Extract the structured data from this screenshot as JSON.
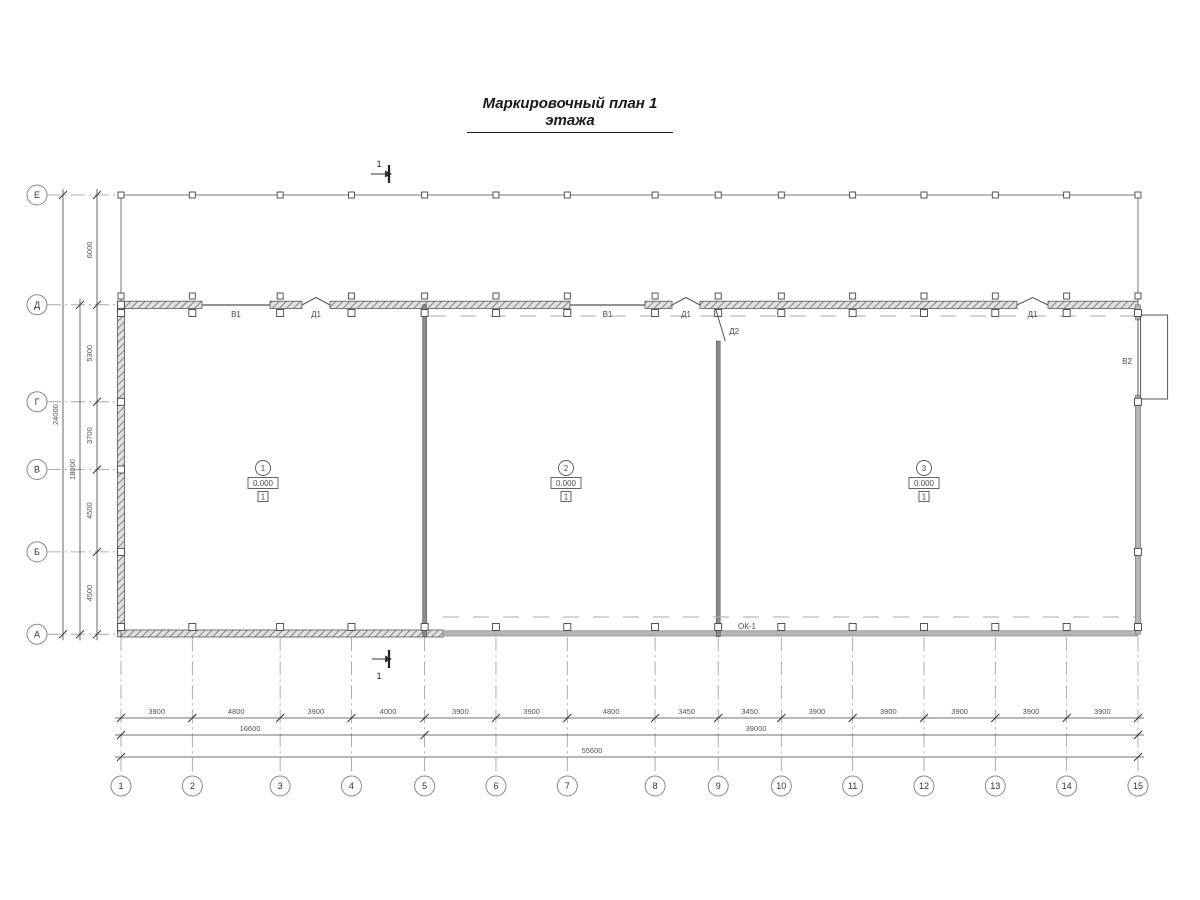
{
  "title": "Маркировочный план 1 этажа",
  "plan": {
    "section_label": "1",
    "axis_rows": [
      {
        "label": "Е"
      },
      {
        "label": "Д"
      },
      {
        "label": "Г"
      },
      {
        "label": "В"
      },
      {
        "label": "Б"
      },
      {
        "label": "А"
      }
    ],
    "row_spans": [
      {
        "label": "6000"
      },
      {
        "label": "5300"
      },
      {
        "label": "3700"
      },
      {
        "label": "4500"
      },
      {
        "label": "4500"
      }
    ],
    "row_totals": [
      {
        "label": "24000",
        "from": 0,
        "to": 5
      },
      {
        "label": "18000",
        "from": 1,
        "to": 5
      }
    ],
    "axis_cols": [
      {
        "label": "1"
      },
      {
        "label": "2"
      },
      {
        "label": "3"
      },
      {
        "label": "4"
      },
      {
        "label": "5"
      },
      {
        "label": "6"
      },
      {
        "label": "7"
      },
      {
        "label": "8"
      },
      {
        "label": "9"
      },
      {
        "label": "10"
      },
      {
        "label": "11"
      },
      {
        "label": "12"
      },
      {
        "label": "13"
      },
      {
        "label": "14"
      },
      {
        "label": "15"
      }
    ],
    "col_spans": [
      {
        "label": "3900"
      },
      {
        "label": "4800"
      },
      {
        "label": "3900"
      },
      {
        "label": "4000"
      },
      {
        "label": "3900"
      },
      {
        "label": "3900"
      },
      {
        "label": "4800"
      },
      {
        "label": "3450"
      },
      {
        "label": "3450"
      },
      {
        "label": "3900"
      },
      {
        "label": "3900"
      },
      {
        "label": "3900"
      },
      {
        "label": "3900"
      },
      {
        "label": "3900"
      }
    ],
    "col_totals": [
      {
        "label": "16600",
        "from": 0,
        "to": 4,
        "lx": 250
      },
      {
        "label": "39000",
        "from": 4,
        "to": 14,
        "lx": 756
      },
      {
        "label": "55600",
        "from": 0,
        "to": 14,
        "lx": 592
      }
    ],
    "openings": {
      "windows_top": [
        {
          "label": "В1",
          "from": 202,
          "to": 270
        },
        {
          "label": "В1",
          "from": 570,
          "to": 645
        }
      ],
      "doors_top": [
        {
          "label": "Д1",
          "from": 302,
          "to": 330
        },
        {
          "label": "Д1",
          "from": 672,
          "to": 700
        },
        {
          "label": "Д1",
          "from": 1017,
          "to": 1048
        }
      ],
      "door_interior": {
        "label": "Д2"
      },
      "gate_right": {
        "label": "В2"
      },
      "window_bottom": {
        "label": "ОК-1"
      }
    },
    "rooms": [
      {
        "number": "1",
        "elevation": "0.000",
        "floor_type": "1",
        "x": 263
      },
      {
        "number": "2",
        "elevation": "0.000",
        "floor_type": "1",
        "x": 566
      },
      {
        "number": "3",
        "elevation": "0.000",
        "floor_type": "1",
        "x": 924
      }
    ],
    "colors": {
      "line": "#444444",
      "dim": "#555555",
      "wall_gray": "#b5b5b5",
      "dash": "#aaaaaa"
    }
  }
}
